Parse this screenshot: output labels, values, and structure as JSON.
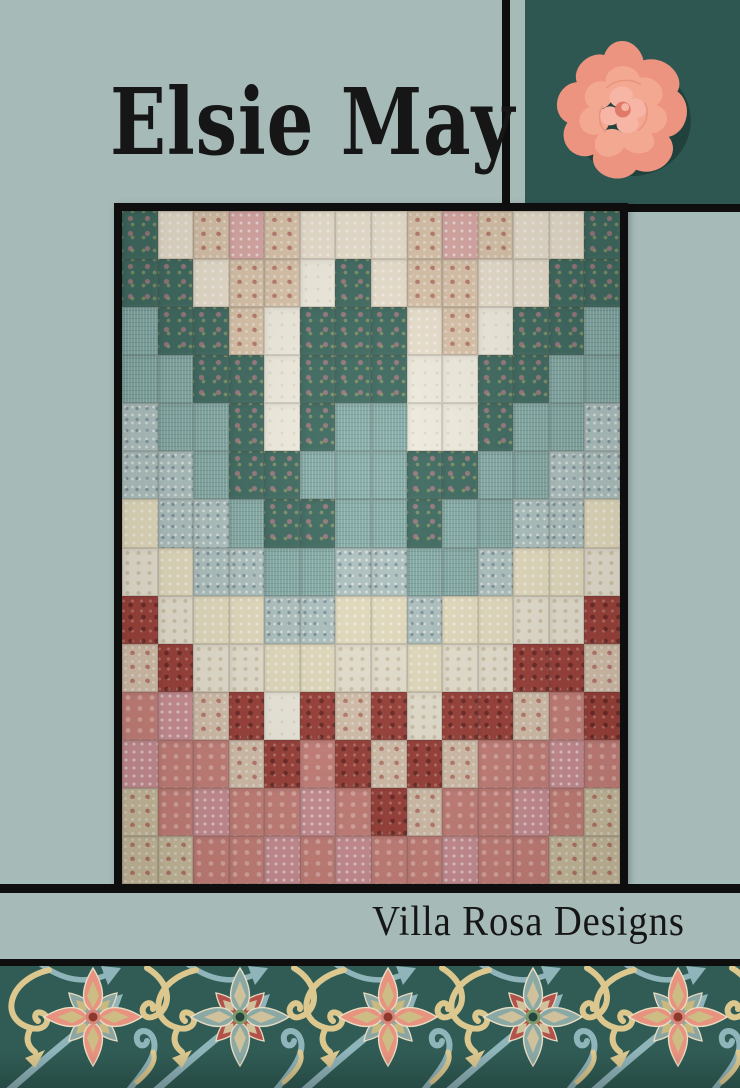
{
  "page": {
    "width": 740,
    "height": 1088
  },
  "css_vars": {
    "--sage": "#a6bab8",
    "--teal-panel": "#2e5751",
    "--teal-border": "#305c55",
    "--black": "#0e0e0e",
    "--ink": "#161616",
    "--rose-outer": "#ec9480",
    "--rose-mid": "#f3a892",
    "--rose-inner": "#f6b5a5",
    "--rose-deep": "#e07a68"
  },
  "title": {
    "text": "Elsie May",
    "color": "#161616"
  },
  "brand": {
    "text": "Villa Rosa Designs",
    "color": "#161616"
  },
  "rose_image": {
    "alt": "pink garden rose on dark teal square"
  },
  "quilt_photo": {
    "alt": "patchwork quilt of small rectangles in a zigzag bargello of cream, blush, teal, blue, ivory, red and rose floral fabrics, black framed",
    "palette": {
      "t": {
        "name": "dark teal floral",
        "hex": "#3f6b61"
      },
      "c": {
        "name": "cream dot",
        "hex": "#ece2cf"
      },
      "b": {
        "name": "blush rose floral",
        "hex": "#dcc6ab"
      },
      "p": {
        "name": "pink ditsy",
        "hex": "#dcaaa6"
      },
      "w": {
        "name": "ivory white",
        "hex": "#f2eee1"
      },
      "q": {
        "name": "blue-green weave",
        "hex": "#83aaa5"
      },
      "l": {
        "name": "light blue floral",
        "hex": "#b0c4c1"
      },
      "y": {
        "name": "pale yellow floral",
        "hex": "#e7dfc0"
      },
      "i": {
        "name": "ivory feather",
        "hex": "#eae4d3"
      },
      "r": {
        "name": "dark red paisley",
        "hex": "#9e413a"
      },
      "k": {
        "name": "cream red-rose floral",
        "hex": "#d9c4ae"
      },
      "s": {
        "name": "rose pink",
        "hex": "#cb837c"
      },
      "h": {
        "name": "pink hydrangea",
        "hex": "#cf9297"
      },
      "g": {
        "name": "tan sage floral",
        "hex": "#cfc2a2"
      }
    },
    "rows": [
      "tcbpbcccbpbcct",
      "ttcbbwtcbbcctt",
      "qttbwtttcbwttq",
      "qqttwtttwwttqq",
      "lqqtwtqqwwtqql",
      "llqttqqqttqqll",
      "yllqttqqtqqlly",
      "iyllqqllqqlyyi",
      "riyyllyylyyiir",
      "kriiyyiiyiirrk",
      "shkrwrkrirrksr",
      "hsskrsrkrksshs",
      "gshsshsrksshsg",
      "ggsshshsshssgg"
    ]
  },
  "border": {
    "flower_positions": [
      {
        "x": 93,
        "type": "pink"
      },
      {
        "x": 240,
        "type": "teal"
      },
      {
        "x": 388,
        "type": "pink"
      },
      {
        "x": 533,
        "type": "teal"
      },
      {
        "x": 678,
        "type": "pink"
      }
    ],
    "flower_colors": {
      "pink": {
        "main": "#e8937f",
        "mainInner": "#cdbd85",
        "diag": "#8ba6a2",
        "diagInner": "#c9b97f",
        "ring": "#d4887a",
        "dot": "#8e382e",
        "outline": "#e9dcc2"
      },
      "teal": {
        "main": "#8aa9a5",
        "mainInner": "#cfc19b",
        "diag": "#b2524a",
        "diagInner": "#cfc19b",
        "ring": "#7d9b6a",
        "dot": "#27463f",
        "outline": "#e9dcc2"
      }
    },
    "vine_colors": {
      "yellow": "#dcc88f",
      "blue": "#8fb4ba"
    }
  }
}
